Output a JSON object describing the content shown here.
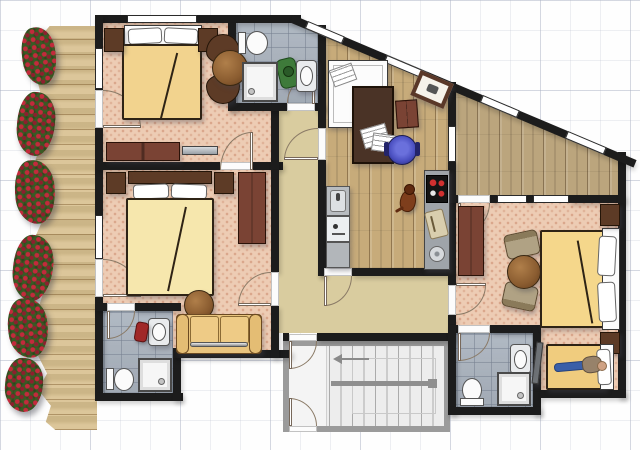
{
  "plan": {
    "type": "apartment-floor-plan",
    "visible_text": "none",
    "grid": "light-gray graph paper, 30px minor / 90px major"
  },
  "colors": {
    "wall": "#1c1c1c",
    "carpet": "#edccb4",
    "hall": "#d9cc9f",
    "tile": "#aab3be",
    "stairwall": "#9b9b9b",
    "stairfloor": "#ededed",
    "furndark": "#5d3b26",
    "furnred": "#7a4334",
    "blanket1": "#f2d38e",
    "blanket2": "#f6e7ad",
    "blanket3": "#f5d78b",
    "blanket4": "#f0cc7e",
    "sofa": "#e9c47e",
    "chairblue": "#4a4fc0",
    "plantred": "#c32a3c",
    "plantgreen": "#2f4a1f",
    "woodfloor": "#c7ab7a",
    "deckwood": "#d8c08f"
  },
  "rooms": [
    {
      "name": "balcony",
      "floor": "wood-deck",
      "furniture": [
        "flower-planter",
        "flower-planter",
        "flower-planter",
        "flower-planter",
        "flower-planter",
        "flower-planter"
      ]
    },
    {
      "name": "bedroom-top-left",
      "floor": "carpet",
      "furniture": [
        "double-bed",
        "pillow",
        "pillow",
        "nightstand",
        "nightstand",
        "armchair",
        "armchair",
        "round-table",
        "sideboard",
        "tv-bar"
      ],
      "doors": [
        "balcony-door",
        "hallway-door"
      ],
      "windows": 2
    },
    {
      "name": "bedroom-middle-left",
      "floor": "carpet",
      "furniture": [
        "double-bed",
        "pillow",
        "pillow",
        "nightstand",
        "nightstand",
        "wardrobe",
        "sofa",
        "round-table"
      ],
      "doors": [
        "balcony-door",
        "hallway-door"
      ],
      "windows": 1
    },
    {
      "name": "bathroom-top",
      "floor": "tiles",
      "furniture": [
        "toilet",
        "laundry-basket",
        "sink",
        "shower"
      ],
      "doors": [
        "hallway-door"
      ]
    },
    {
      "name": "office-kitchen",
      "floor": "wood",
      "furniture": [
        "daybed",
        "notepad",
        "desk",
        "papers",
        "office-chair",
        "side-chair",
        "picture-frame",
        "dog",
        "kitchen-sink",
        "dishwasher",
        "counter",
        "stove",
        "cutting-board",
        "bar-sink"
      ],
      "doors": [
        "hallway-door",
        "hallway-door-2"
      ]
    },
    {
      "name": "corridor-diagonal",
      "floor": "wood",
      "windows": 4
    },
    {
      "name": "hallway",
      "floor": "khaki"
    },
    {
      "name": "bedroom-right",
      "floor": "carpet",
      "furniture": [
        "double-bed",
        "pillow",
        "pillow",
        "nightstand",
        "nightstand",
        "wardrobe",
        "chair",
        "chair",
        "round-table",
        "single-bed",
        "person",
        "tv-panel"
      ],
      "doors": [
        "corridor-door",
        "hallway-door"
      ],
      "windows": 2
    },
    {
      "name": "bathroom-bottom-left",
      "floor": "tiles",
      "furniture": [
        "sink",
        "towel-basket",
        "toilet",
        "shower"
      ],
      "doors": [
        "bedroom-door"
      ]
    },
    {
      "name": "bathroom-bottom-right",
      "floor": "tiles",
      "furniture": [
        "sink",
        "toilet",
        "shower"
      ],
      "doors": [
        "hallway-door"
      ]
    },
    {
      "name": "stairwell",
      "floor": "concrete",
      "furniture": [
        "u-stairs",
        "handrail",
        "direction-arrow"
      ],
      "doors": [
        "lobby-door-top",
        "entrance-door-bottom"
      ]
    }
  ]
}
